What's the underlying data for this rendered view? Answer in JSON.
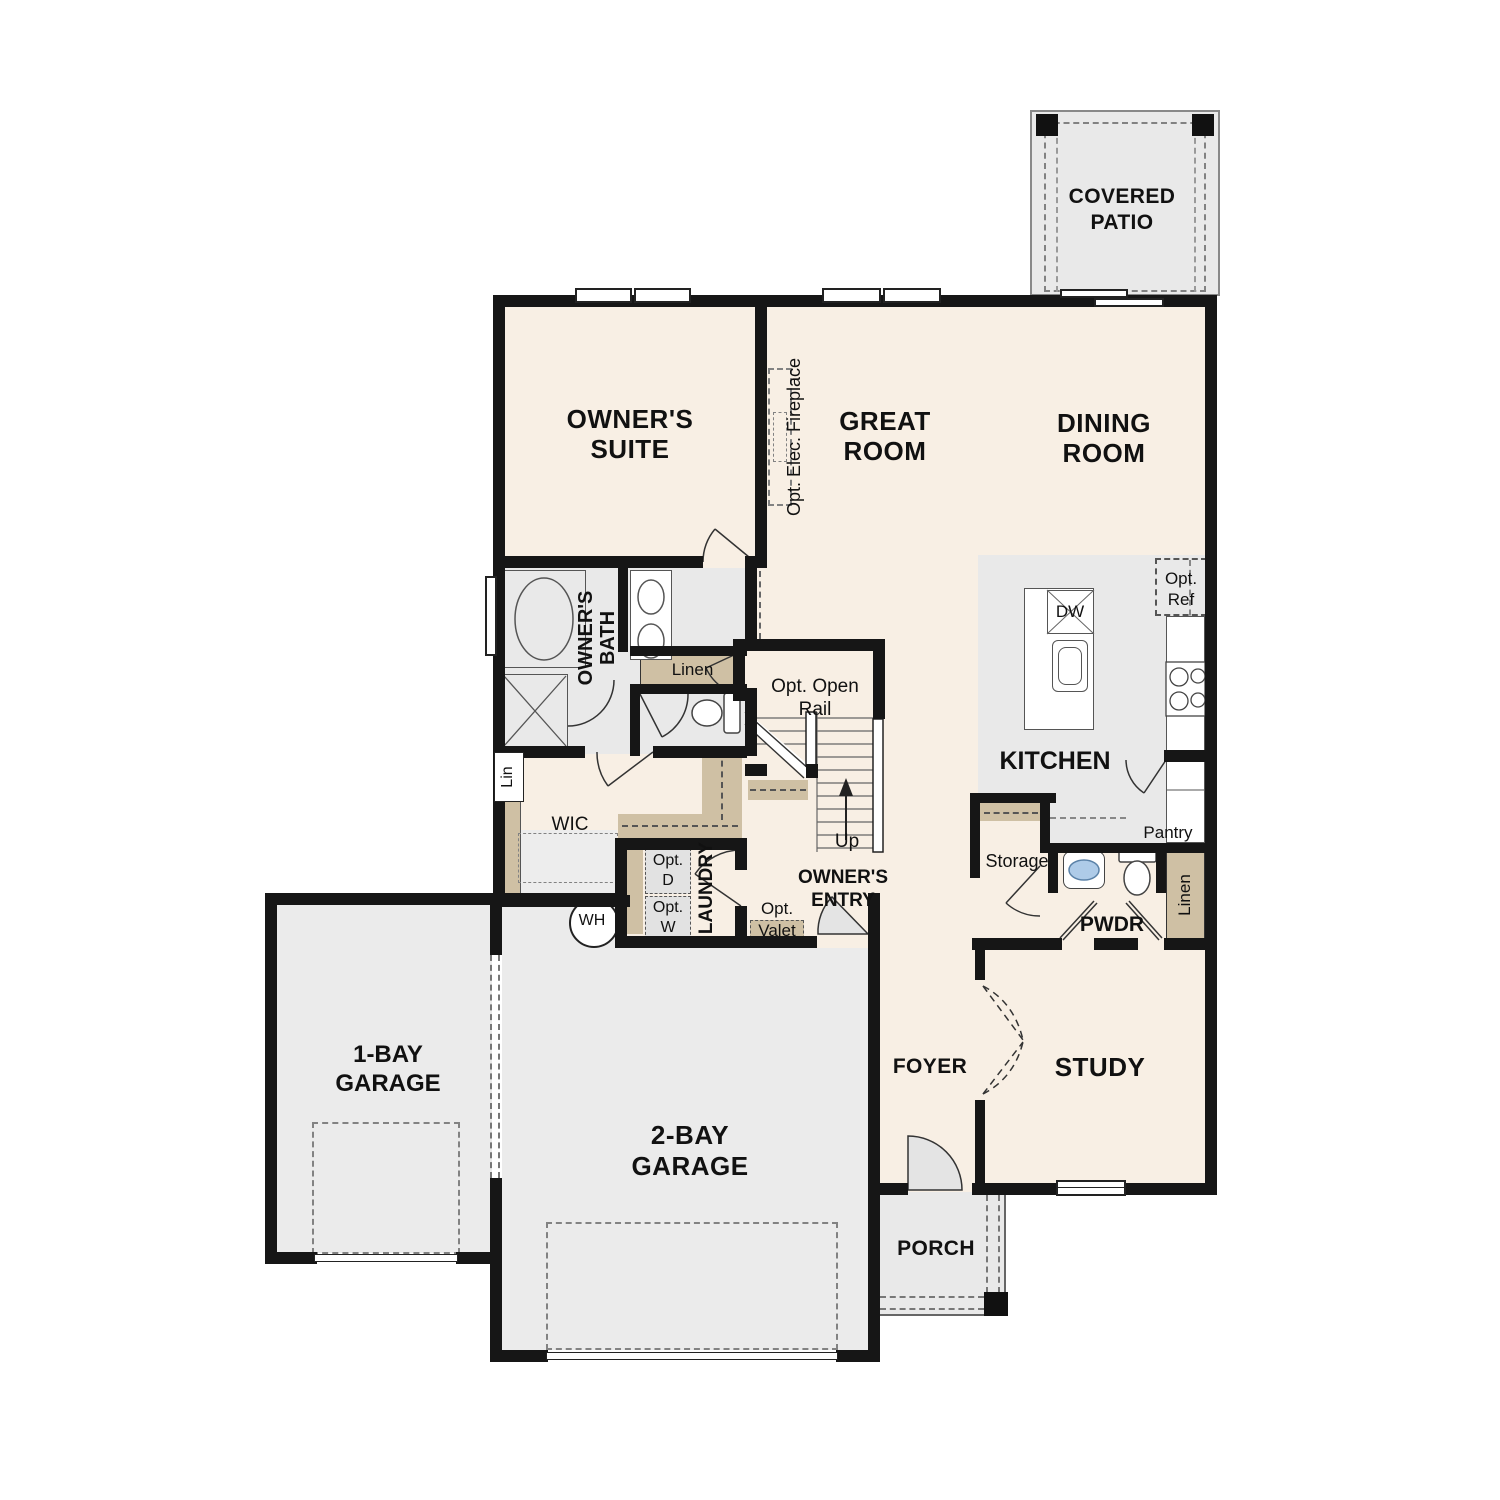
{
  "plan_title": "First floor residential floor plan",
  "colors": {
    "floor_cream": "#f8efe4",
    "floor_gray": "#e9e9e9",
    "cabinet_tan": "#cfc0a4",
    "wall_black": "#161616",
    "sink_blue": "#aecbe8"
  },
  "rooms": {
    "covered_patio": "COVERED\nPATIO",
    "owners_suite": "OWNER'S\nSUITE",
    "great_room": "GREAT\nROOM",
    "dining_room": "DINING\nROOM",
    "owners_bath": "OWNER'S\nBATH",
    "wic": "WIC",
    "kitchen": "KITCHEN",
    "laundry": "LAUNDRY",
    "owners_entry": "OWNER'S\nENTRY",
    "pwdr": "PWDR",
    "storage": "Storage",
    "pantry": "Pantry",
    "foyer": "FOYER",
    "study": "STUDY",
    "garage_1bay": "1-BAY\nGARAGE",
    "garage_2bay": "2-BAY\nGARAGE",
    "porch": "PORCH"
  },
  "annotations": {
    "fireplace": "Opt. Elec. Fireplace",
    "open_rail": "Opt. Open\nRail",
    "up": "Up",
    "linen_bath": "Linen",
    "lin": "Lin",
    "linen_hall": "Linen",
    "opt_valet": "Opt.\nValet",
    "wh": "WH",
    "opt_d": "Opt.\nD",
    "opt_w": "Opt.\nW",
    "dw": "DW",
    "opt_ref": "Opt.\nRef"
  }
}
